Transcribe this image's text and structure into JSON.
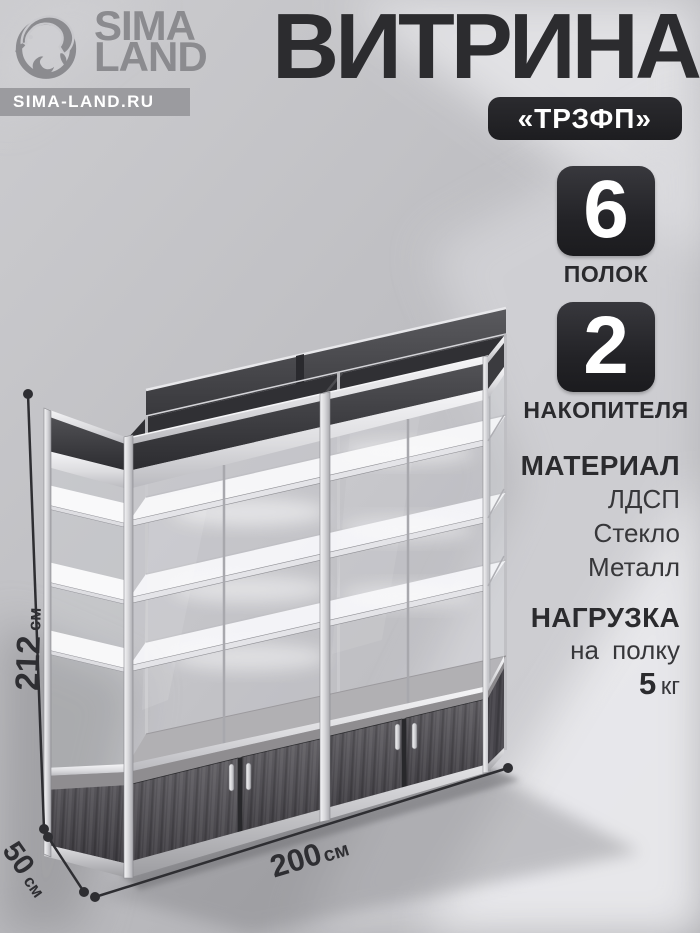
{
  "brand": {
    "line1": "SIMA",
    "line2": "LAND",
    "site": "SIMA-LAND.RU"
  },
  "header": {
    "title": "ВИТРИНА",
    "model_badge": "«ТРЗФП»"
  },
  "stats": [
    {
      "value": "6",
      "label": "ПОЛОК"
    },
    {
      "value": "2",
      "label": "НАКОПИТЕЛЯ"
    }
  ],
  "specs": {
    "material": {
      "heading": "МАТЕРИАЛ",
      "items": [
        "ЛДСП",
        "Стекло",
        "Металл"
      ]
    },
    "load": {
      "heading": "НАГРУЗКА",
      "condition": "на полку",
      "value": "5",
      "unit": "кг"
    }
  },
  "dimensions": {
    "height": {
      "value": "212",
      "unit": "см"
    },
    "width": {
      "value": "200",
      "unit": "см"
    },
    "depth": {
      "value": "50",
      "unit": "см"
    }
  },
  "icons": {
    "brand": "dolphin-wave-ring-icon"
  },
  "colors": {
    "badge_bg": "#242428",
    "title_text": "#2c2c2f",
    "logo_gray": "#8b8b8f",
    "site_bar_bg": "#9b9b9f",
    "background": "#c3c3c7",
    "dimension_lines": "#2e2e32",
    "aluminum": "#d9d9dd",
    "dark_wood": "#4c4a4f"
  }
}
